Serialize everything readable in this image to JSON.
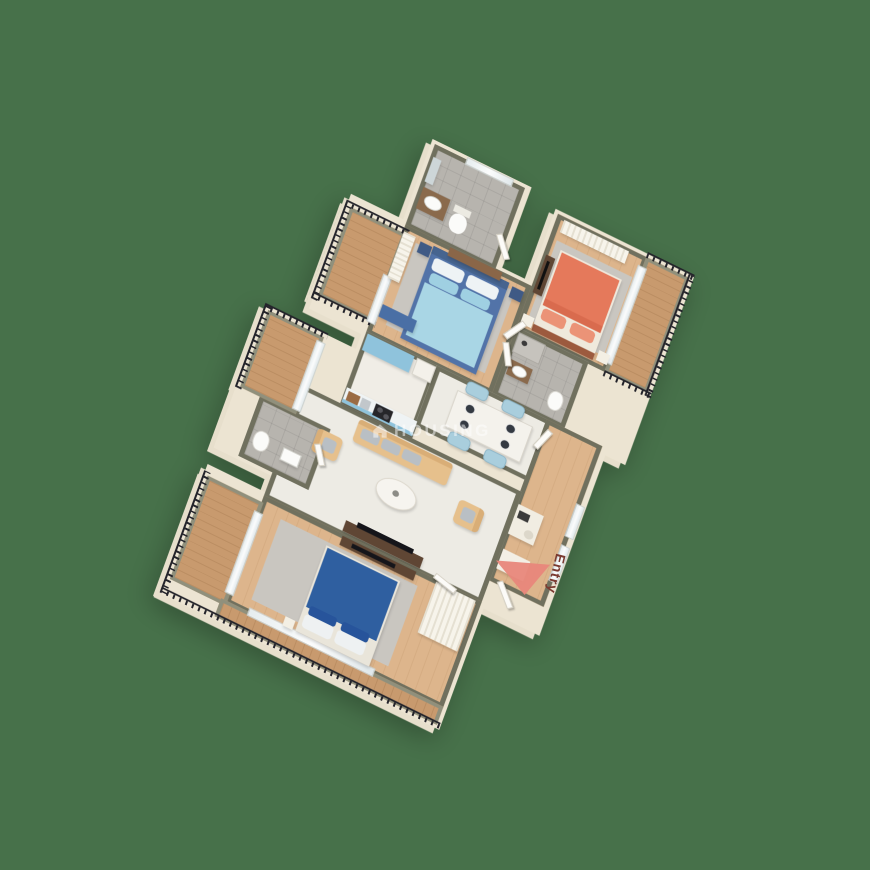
{
  "watermark": {
    "text": "HOUSING",
    "icon": "house-icon"
  },
  "entry": {
    "label": "Entry"
  },
  "colors": {
    "bg": "#47714a",
    "wall": "#70705e",
    "woodFloor": "#ddb58c",
    "balconyWood": "#c89a6e",
    "tile": "#b7b4ae",
    "marble": "#edebe4",
    "railing": "#23232a",
    "bedBlue": "#5273a8",
    "bedding": "#a9d6e5",
    "bedNavy": "#2f5fa0",
    "bedCoral": "#e5795b",
    "sofaTan": "#e6c08c",
    "chairBlue": "#a9cedd",
    "kitchenBlue": "#8fc3dc",
    "woodDark": "#5f4634",
    "arrowRed": "#e8877b",
    "entryText": "#7a3a30"
  },
  "scene": {
    "type": "3d-isometric-floorplan",
    "rooms": [
      {
        "name": "bathroom-top",
        "furniture": [
          "vanity-sink",
          "toilet",
          "mirror",
          "window"
        ]
      },
      {
        "name": "bedroom-coral",
        "furniture": [
          "double-bed-coral",
          "rug",
          "nightstands",
          "tv-console",
          "wardrobe"
        ]
      },
      {
        "name": "balcony-right",
        "furniture": [
          "iron-railing",
          "sliding-glass-door"
        ]
      },
      {
        "name": "bathroom-ensuite",
        "furniture": [
          "vanity-sink",
          "toilet",
          "shower"
        ]
      },
      {
        "name": "bedroom-master-blue",
        "furniture": [
          "double-bed-blue",
          "rug",
          "wardrobe-louvered",
          "bench-blue",
          "dresser",
          "nightstands"
        ]
      },
      {
        "name": "balcony-top-left",
        "furniture": [
          "iron-railing",
          "sliding-glass-door"
        ]
      },
      {
        "name": "kitchen",
        "furniture": [
          "blue-cabinet",
          "fridge",
          "counter",
          "stove",
          "sink"
        ]
      },
      {
        "name": "dining",
        "furniture": [
          "table",
          "4-chairs",
          "4-plates"
        ]
      },
      {
        "name": "foyer-corridor",
        "furniture": [
          "desk",
          "cabinet",
          "windows",
          "entry-door"
        ]
      },
      {
        "name": "living",
        "furniture": [
          "sofa-tan",
          "armchair-left",
          "armchair-right",
          "coffee-table",
          "tv-console"
        ]
      },
      {
        "name": "bathroom-powder",
        "furniture": [
          "toilet",
          "sink"
        ]
      },
      {
        "name": "balcony-left",
        "furniture": [
          "iron-railing"
        ]
      },
      {
        "name": "bedroom-bottom-navy",
        "furniture": [
          "double-bed-navy",
          "rug",
          "tv-shelf",
          "wardrobe"
        ]
      },
      {
        "name": "balcony-bottom",
        "furniture": [
          "iron-railing"
        ]
      }
    ]
  }
}
